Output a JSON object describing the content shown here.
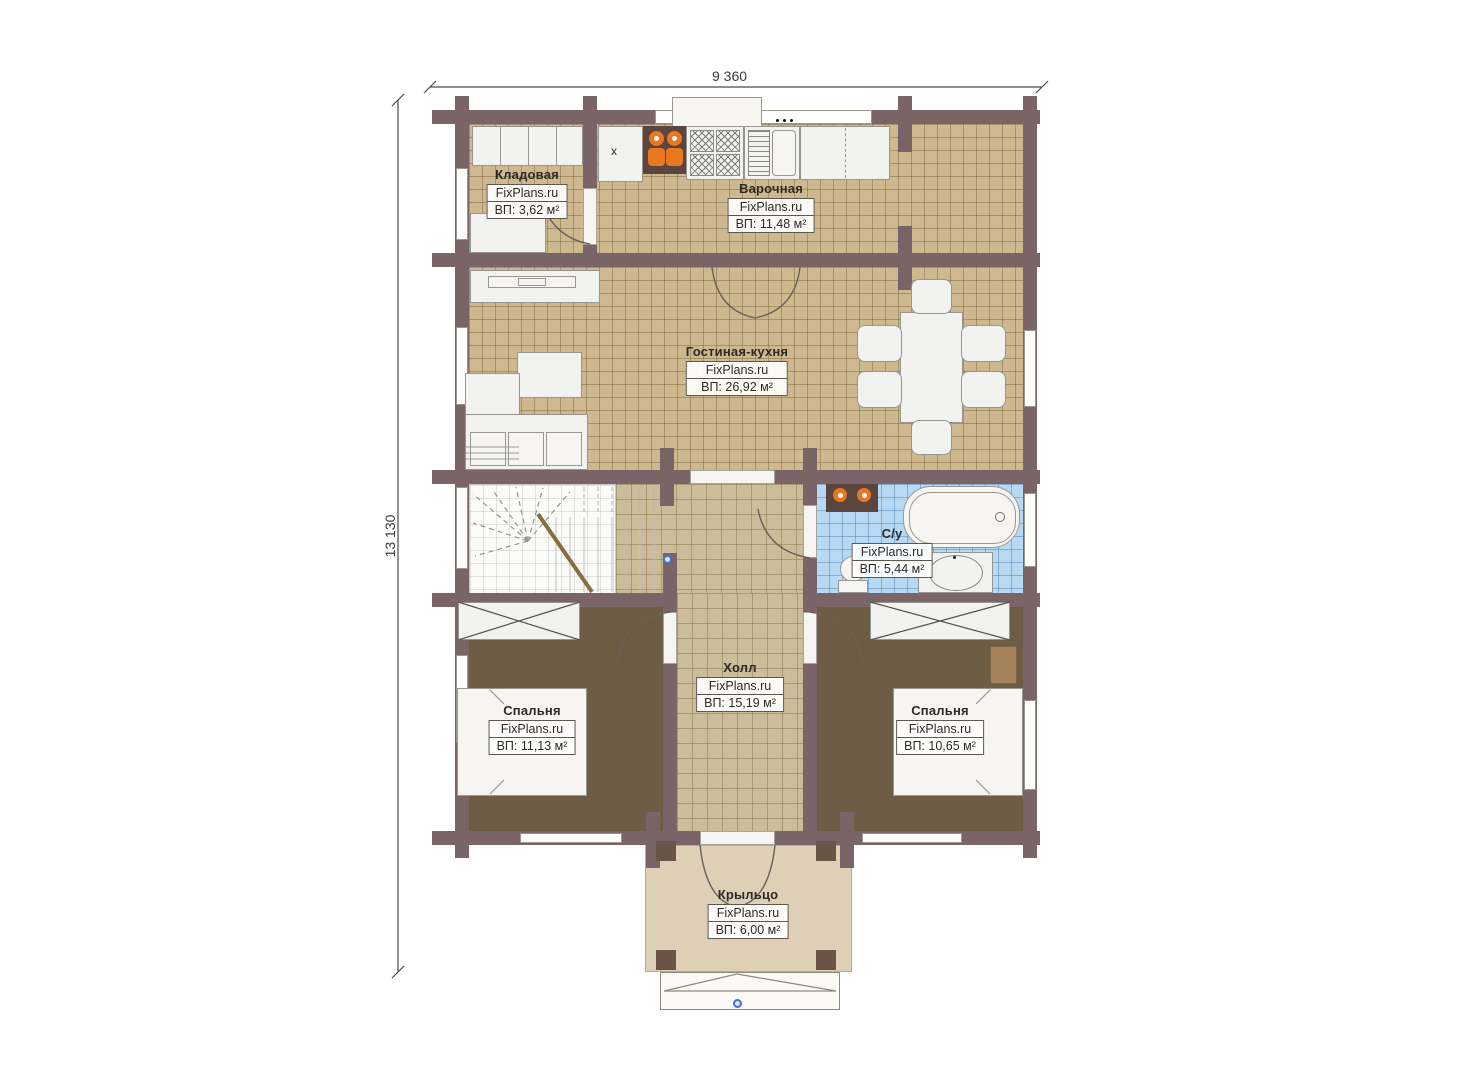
{
  "plan": {
    "title_context": "floor-plan drawing",
    "dimensions": {
      "width_label": "9 360",
      "height_label": "13 130"
    },
    "kitchen_marker": "x"
  },
  "rooms": [
    {
      "id": "kladovaya",
      "name": "Кладовая",
      "brand": "FixPlans.ru",
      "area": "ВП: 3,62 м²"
    },
    {
      "id": "varochnaya",
      "name": "Варочная",
      "brand": "FixPlans.ru",
      "area": "ВП: 11,48 м²"
    },
    {
      "id": "gostinaya",
      "name": "Гостиная-кухня",
      "brand": "FixPlans.ru",
      "area": "ВП: 26,92 м²"
    },
    {
      "id": "su",
      "name": "С/у",
      "brand": "FixPlans.ru",
      "area": "ВП: 5,44 м²"
    },
    {
      "id": "holl",
      "name": "Холл",
      "brand": "FixPlans.ru",
      "area": "ВП: 15,19 м²"
    },
    {
      "id": "spalnya1",
      "name": "Спальня",
      "brand": "FixPlans.ru",
      "area": "ВП: 11,13 м²"
    },
    {
      "id": "spalnya2",
      "name": "Спальня",
      "brand": "FixPlans.ru",
      "area": "ВП: 10,65 м²"
    },
    {
      "id": "kryltso",
      "name": "Крыльцо",
      "brand": "FixPlans.ru",
      "area": "ВП: 6,00 м²"
    }
  ],
  "colors": {
    "wall": "#7b6467",
    "floor_tile_tan": "#cdb88f",
    "floor_hall": "#cbbd99",
    "floor_bedroom": "#6e5d45",
    "floor_bathroom": "#b7d9f3",
    "porch": "#ddd0b7",
    "furniture": "#f2f2f0",
    "accent_orange": "#e87820",
    "marker_blue": "#3f72c8"
  }
}
